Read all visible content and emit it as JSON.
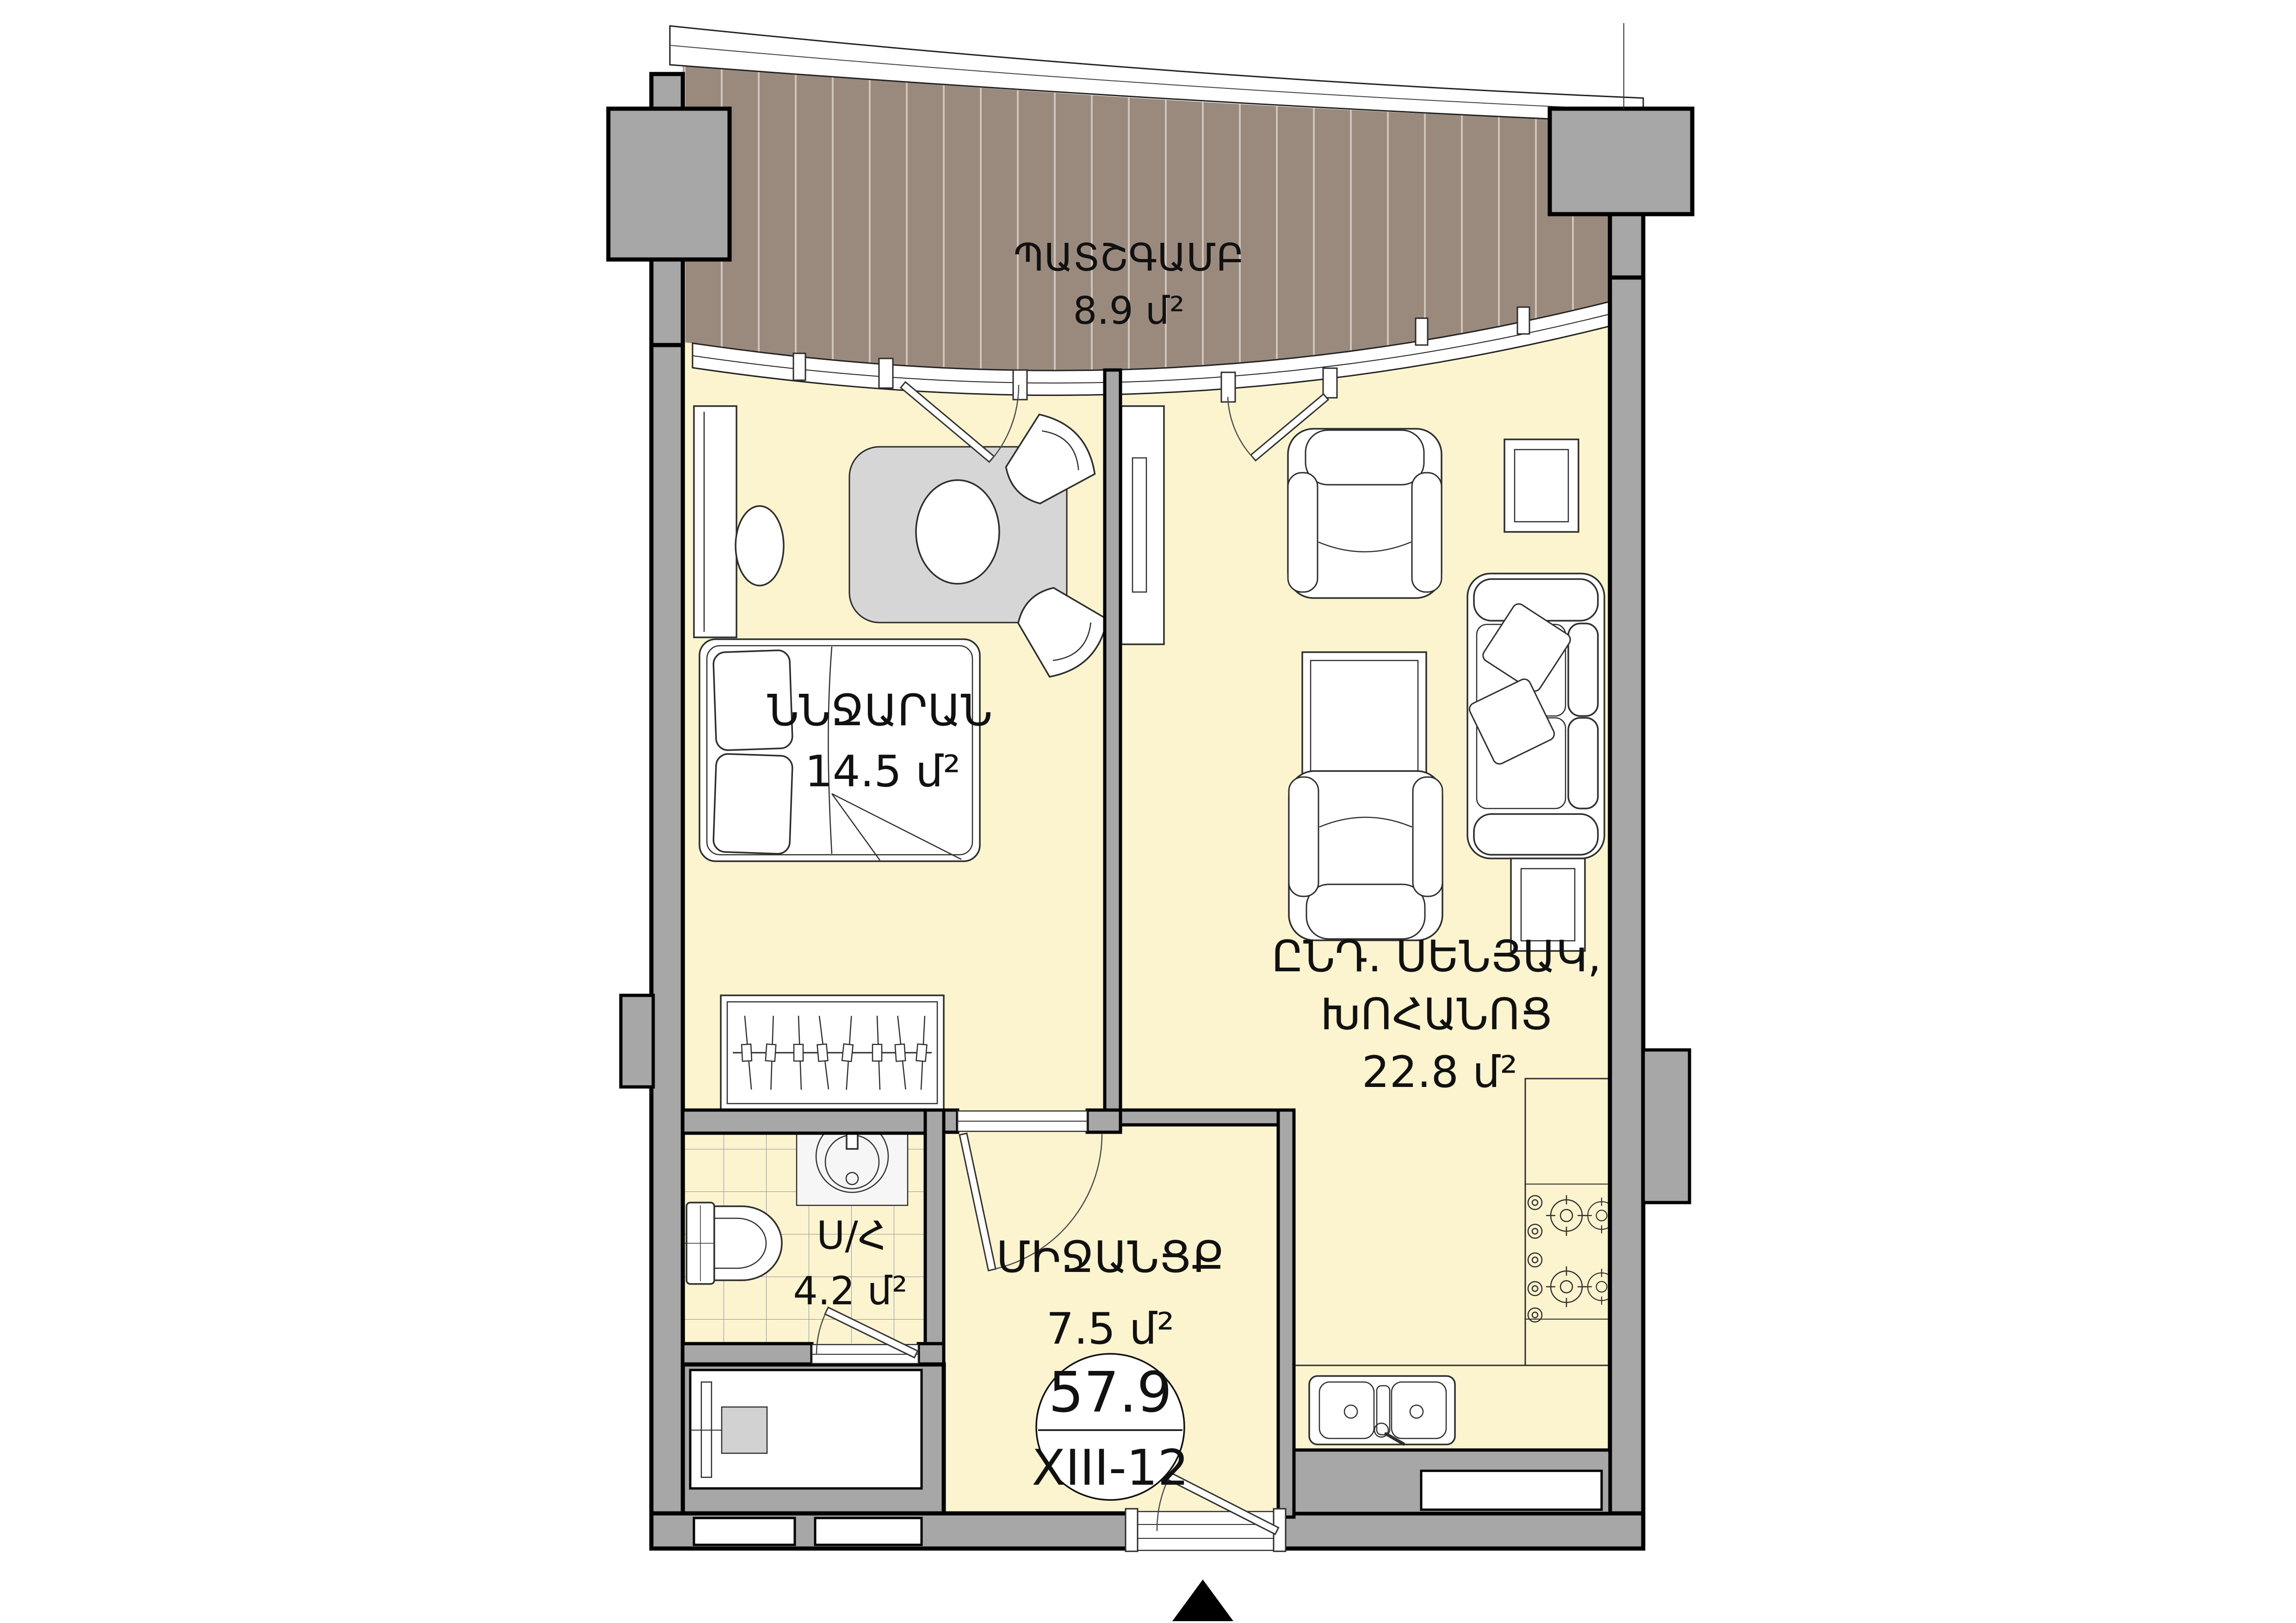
{
  "badge": {
    "total_area": "57.9",
    "unit_number": "XIII-12"
  },
  "rooms": {
    "balcony": {
      "name": "ՊԱՏՇԳԱՄԲ",
      "area": "8.9 մ²"
    },
    "bedroom": {
      "name": "ՆՆՋԱՐԱՆ",
      "area": "14.5 մ²"
    },
    "living_kitchen": {
      "name_line1": "ԸՆԴ. ՍԵՆՅԱԿ,",
      "name_line2": "ԽՈՀԱՆՈՑ",
      "area": "22.8 մ²"
    },
    "corridor": {
      "name": "ՄԻՋԱՆՑՔ",
      "area": "7.5 մ²"
    },
    "bathroom": {
      "name": "Ս/Հ",
      "area": "4.2 մ²"
    }
  },
  "colors": {
    "room_fill": "#FBF4CF",
    "balcony_fill": "#9A897D",
    "balcony_stripe": "#CFC5BC",
    "wall_fill": "#A7A7A7",
    "rug_fill": "#D6D6D6",
    "outline": "#000000"
  },
  "icons": {
    "north_arrow": "north-arrow"
  }
}
